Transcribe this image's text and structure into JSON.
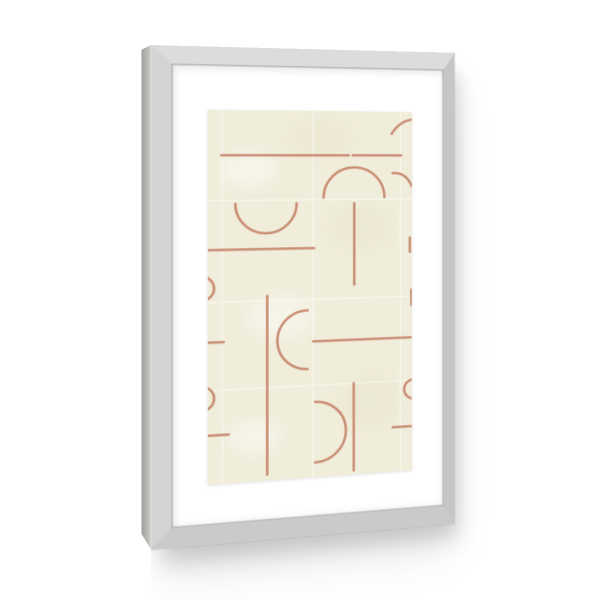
{
  "palette": {
    "background": "#ffffff",
    "frame_top": "#dcdcdc",
    "frame_right": "#c6c6c8",
    "frame_bottom": "#cacac9",
    "frame_left": "#d3d3d2",
    "frame_side_near": "#c9c9c5",
    "frame_side_far": "#9e9e9a",
    "frame_side_edge": "#efefed",
    "mat": "#ffffff",
    "paper": "#f0edda",
    "stroke": "#c5846b",
    "seam": "#ffffff"
  },
  "frame": {
    "description": "silver-gray aluminium picture frame, slight right-receding angle",
    "mat_description": "wide white mat board",
    "shadow": "soft gray drop shadow below frame"
  },
  "artwork": {
    "description": "abstract-line-tiles",
    "canvas": {
      "width": 204,
      "height": 375
    },
    "stroke_width": 2.5,
    "stroke_opacity": 0.92,
    "seam_width": 1.3,
    "seam_opacity": 0.55,
    "seams": {
      "vertical_x": [
        14,
        103,
        192
      ],
      "horizontal_y": [
        91,
        193,
        281
      ]
    },
    "strokes": [
      {
        "name": "top-left-horizontal-line",
        "kind": "line",
        "x1": 13,
        "y1": 45.5,
        "x2": 139,
        "y2": 45.5
      },
      {
        "name": "top-right-horizontal-line",
        "kind": "line",
        "x1": 143,
        "y1": 45.5,
        "x2": 193,
        "y2": 45.5
      },
      {
        "name": "row2-left-horizontal-line",
        "kind": "line",
        "x1": 0,
        "y1": 140.5,
        "x2": 104,
        "y2": 140.5
      },
      {
        "name": "down-bowl-semicircle",
        "kind": "path",
        "d": "M 26.5 94.5 A 30 30 0 0 0 86.5 94.5"
      },
      {
        "name": "dome-semicircle",
        "kind": "path",
        "d": "M 113.5 89 A 31 31 0 0 1 175.5 89"
      },
      {
        "name": "dome-stem-vertical-line",
        "kind": "line",
        "x1": 144.5,
        "y1": 95,
        "x2": 144.5,
        "y2": 179
      },
      {
        "name": "long-vertical-line",
        "kind": "line",
        "x1": 57.5,
        "y1": 188,
        "x2": 57.5,
        "y2": 369
      },
      {
        "name": "left-opening-semicircle",
        "kind": "path",
        "d": "M 97.5 204 A 30 30 0 0 0 97.5 264"
      },
      {
        "name": "mid-right-horizontal-line",
        "kind": "line",
        "x1": 103,
        "y1": 236,
        "x2": 203,
        "y2": 236
      },
      {
        "name": "left-edge-short-line",
        "kind": "line",
        "x1": 0,
        "y1": 233,
        "x2": 15,
        "y2": 233
      },
      {
        "name": "right-opening-semicircle",
        "kind": "path",
        "d": "M 105 298 A 31 31 0 0 1 105 360"
      },
      {
        "name": "bottom-right-vertical-line",
        "kind": "line",
        "x1": 144,
        "y1": 281,
        "x2": 144,
        "y2": 371
      },
      {
        "name": "bottom-left-short-line",
        "kind": "line",
        "x1": 0,
        "y1": 326,
        "x2": 20,
        "y2": 326
      },
      {
        "name": "left-edge-arc-upper",
        "kind": "path",
        "d": "M 0 168.6 A 12 12 0 0 1 0 189.4"
      },
      {
        "name": "left-edge-arc-lower",
        "kind": "path",
        "d": "M 0 278.6 A 12 12 0 0 1 0 299.4"
      },
      {
        "name": "right-edge-curve-top",
        "kind": "path",
        "d": "M 183 23 Q 191 10 204 8"
      },
      {
        "name": "right-edge-curve-upper",
        "kind": "path",
        "d": "M 184 64 Q 198 63 204 78"
      },
      {
        "name": "right-edge-vertical-a",
        "kind": "line",
        "x1": 202,
        "y1": 131.5,
        "x2": 202,
        "y2": 146.5
      },
      {
        "name": "right-edge-vertical-b",
        "kind": "line",
        "x1": 203.5,
        "y1": 186,
        "x2": 203.5,
        "y2": 202
      },
      {
        "name": "right-edge-arc-lower",
        "kind": "path",
        "d": "M 204 280.2 A 10 10 0 0 0 204 299.8"
      },
      {
        "name": "bottom-right-edge-line",
        "kind": "line",
        "x1": 184,
        "y1": 329,
        "x2": 204,
        "y2": 329
      }
    ]
  }
}
